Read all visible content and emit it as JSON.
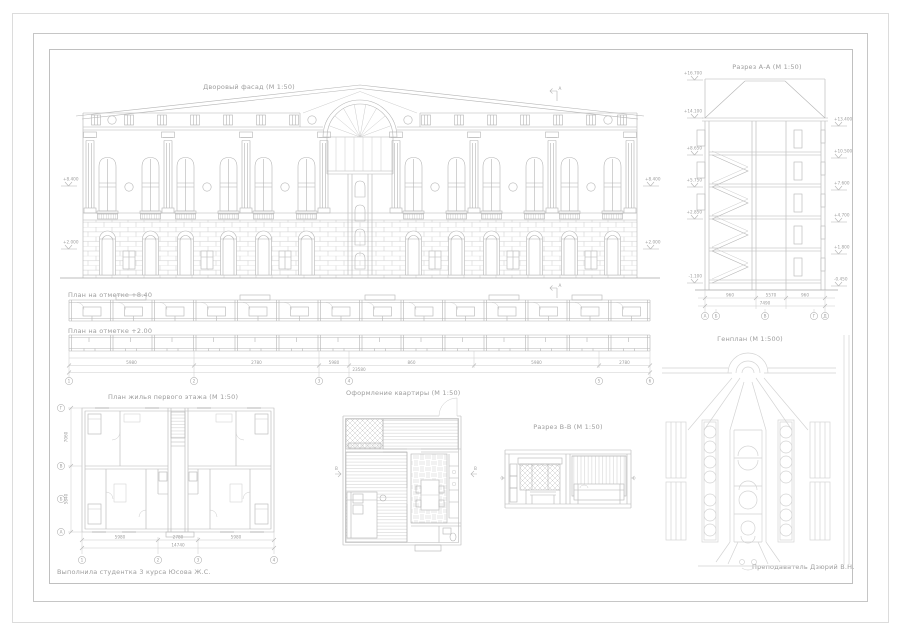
{
  "titles": {
    "facade": "Дворовый фасад (М 1:50)",
    "section_a": "Разрез А-А (М 1:50)",
    "plan_upper": "План на отметке +8.40",
    "plan_lower": "План на отметке +2.00",
    "floor_plan": "План жилья первого этажа (М 1:50)",
    "apartment": "Оформление квартиры (М 1:50)",
    "section_b": "Разрез В-В (М 1:50)",
    "genplan": "Генплан (М 1:500)"
  },
  "signatures": {
    "author": "Выполнила студентка 3 курса Юсова Ж.С.",
    "teacher": "Преподаватель Дзюрий В.Н."
  },
  "facade": {
    "levels_left": [
      "+8.400",
      "+2.000"
    ],
    "levels_right": [
      "+8.400",
      "+2.000"
    ],
    "cut_label": "А"
  },
  "section_a": {
    "levels_left": [
      "+16.700",
      "+14.100",
      "+8.650",
      "+5.750",
      "+2.850",
      "-1.100"
    ],
    "levels_right": [
      "+13.400",
      "+10.500",
      "+7.600",
      "+4.700",
      "+1.800",
      "-0.450"
    ],
    "dims": [
      "960",
      "5570",
      "960"
    ],
    "dim_total": "7490",
    "axes": [
      "А",
      "Б",
      "В",
      "Г",
      "Д"
    ]
  },
  "plans": {
    "cut_label": "А",
    "dims": [
      "5980",
      "2780",
      "5980",
      "860",
      "5980",
      "2780"
    ],
    "dim_total": "23580",
    "axes": [
      "1",
      "2",
      "3",
      "4",
      "5",
      "6"
    ]
  },
  "floor_plan": {
    "dims_bottom": [
      "5980",
      "2780",
      "5980"
    ],
    "dim_total": "14740",
    "dims_left": [
      "7060",
      "5840"
    ],
    "axes_bottom": [
      "1",
      "2",
      "3",
      "4"
    ],
    "axes_left": [
      "А",
      "Б",
      "В",
      "Г"
    ]
  },
  "apartment": {
    "cut_label": "В"
  }
}
